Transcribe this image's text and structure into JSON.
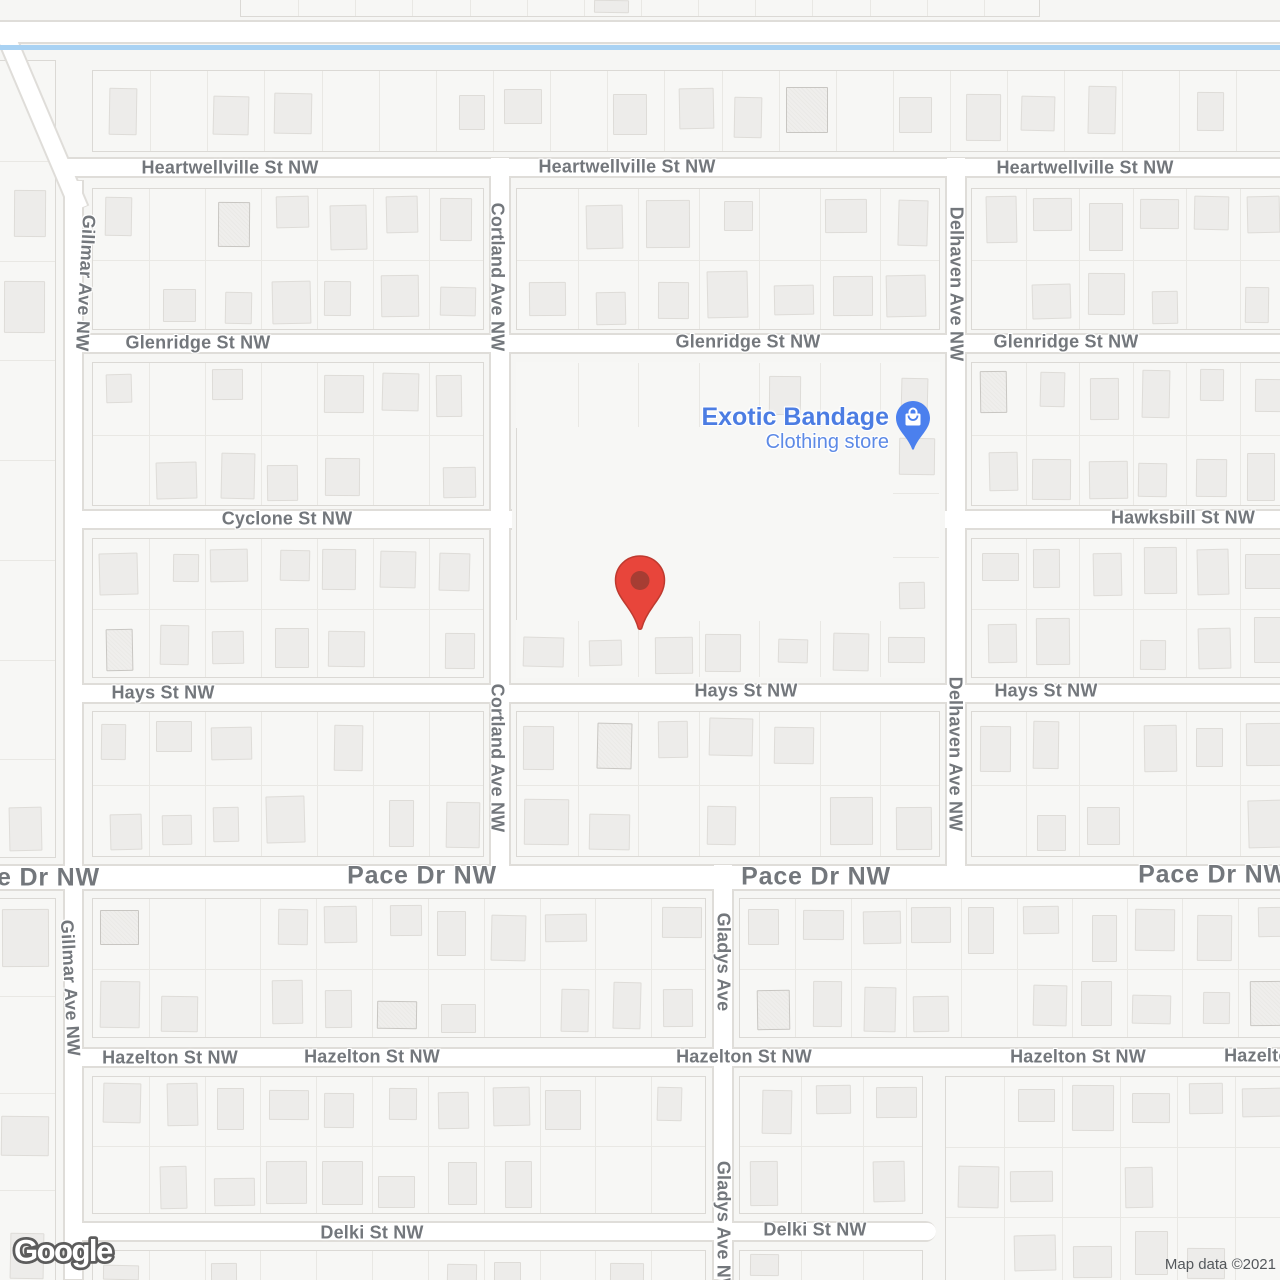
{
  "attribution": {
    "text": "Map data ©2021"
  },
  "logo": {
    "text": "Google"
  },
  "poi": {
    "title": "Exotic Bandage",
    "subtitle": "Clothing store",
    "title_color": "#4c7de3",
    "subtitle_color": "#5d8ae6",
    "icon": {
      "name": "shopping-bag-pin-icon",
      "x": 913,
      "y": 418,
      "color": "#4B80EE"
    }
  },
  "marker": {
    "name": "red-map-pin",
    "x": 640,
    "y": 580,
    "color": "#E8453B",
    "stroke": "#BE3A2F",
    "dot": "#A63D33"
  },
  "theme": {
    "background": "#f6f6f4",
    "block_fill": "#f7f7f5",
    "block_border": "#dbd9d5",
    "lot_line": "#e9e8e4",
    "building_fill": "#edecea",
    "building_border": "#dedcd8",
    "road_fill": "#ffffff",
    "road_casing": "#dfddd9",
    "label_color": "#73777c",
    "water_color": "#a9d2f3"
  },
  "map": {
    "seed": 11,
    "water": {
      "x": 0,
      "y": 45,
      "w": 1280,
      "h": 5
    },
    "roads": [
      {
        "o": "h",
        "x": 0,
        "y": 20,
        "w": 1280,
        "h": 24
      },
      {
        "o": "h",
        "x": 60,
        "y": 157,
        "w": 1220,
        "h": 21
      },
      {
        "o": "h",
        "x": 80,
        "y": 333,
        "w": 1200,
        "h": 21
      },
      {
        "o": "h",
        "x": 80,
        "y": 509,
        "w": 432,
        "h": 21
      },
      {
        "o": "h",
        "x": 945,
        "y": 509,
        "w": 335,
        "h": 21
      },
      {
        "o": "h",
        "x": 78,
        "y": 683,
        "w": 1202,
        "h": 21
      },
      {
        "o": "h",
        "x": 0,
        "y": 864,
        "w": 1280,
        "h": 27,
        "major": true
      },
      {
        "o": "h",
        "x": 78,
        "y": 1047,
        "w": 1202,
        "h": 21
      },
      {
        "o": "h",
        "x": 78,
        "y": 1221,
        "w": 858,
        "h": 21,
        "cap": "right"
      },
      {
        "o": "v",
        "x": 32,
        "y": 27,
        "w": 21,
        "h": 190,
        "rot": -23
      },
      {
        "o": "v",
        "x": 63,
        "y": 180,
        "w": 21,
        "h": 1100
      },
      {
        "o": "v",
        "x": 489,
        "y": 157,
        "w": 22,
        "h": 733
      },
      {
        "o": "v",
        "x": 945,
        "y": 157,
        "w": 22,
        "h": 733
      },
      {
        "o": "v",
        "x": 712,
        "y": 864,
        "w": 22,
        "h": 416
      }
    ],
    "blocks": [
      {
        "x": 240,
        "y": -6,
        "w": 800,
        "h": 23,
        "rows": 1,
        "d": 0.15
      },
      {
        "x": 92,
        "y": 70,
        "w": 1200,
        "h": 82,
        "rows": 1,
        "d": 0.7
      },
      {
        "x": 92,
        "y": 188,
        "w": 392,
        "h": 142,
        "rows": 2,
        "d": 0.75
      },
      {
        "x": 516,
        "y": 188,
        "w": 424,
        "h": 142,
        "rows": 2,
        "d": 0.75
      },
      {
        "x": 971,
        "y": 188,
        "w": 321,
        "h": 142,
        "rows": 2,
        "d": 0.8
      },
      {
        "x": 92,
        "y": 362,
        "w": 392,
        "h": 144,
        "rows": 2,
        "d": 0.7
      },
      {
        "x": 971,
        "y": 362,
        "w": 321,
        "h": 144,
        "rows": 2,
        "d": 0.8
      },
      {
        "x": 92,
        "y": 538,
        "w": 392,
        "h": 140,
        "rows": 2,
        "d": 0.65
      },
      {
        "x": 971,
        "y": 538,
        "w": 321,
        "h": 140,
        "rows": 2,
        "d": 0.8
      },
      {
        "x": 516,
        "y": 362,
        "w": 424,
        "h": 316,
        "rows": 0,
        "d": 0
      },
      {
        "x": 516,
        "y": 362,
        "w": 424,
        "h": 66,
        "rows": 1,
        "d": 0.7,
        "noborder": true
      },
      {
        "x": 892,
        "y": 428,
        "w": 48,
        "h": 192,
        "rows": 3,
        "d": 0.85,
        "noborder": true
      },
      {
        "x": 516,
        "y": 620,
        "w": 424,
        "h": 58,
        "rows": 1,
        "d": 0.8,
        "noborder": true
      },
      {
        "x": 92,
        "y": 711,
        "w": 392,
        "h": 146,
        "rows": 2,
        "d": 0.7
      },
      {
        "x": 516,
        "y": 711,
        "w": 424,
        "h": 146,
        "rows": 2,
        "d": 0.75
      },
      {
        "x": 971,
        "y": 711,
        "w": 321,
        "h": 146,
        "rows": 2,
        "d": 0.8
      },
      {
        "x": 92,
        "y": 898,
        "w": 614,
        "h": 140,
        "rows": 2,
        "d": 0.75
      },
      {
        "x": 739,
        "y": 898,
        "w": 553,
        "h": 140,
        "rows": 2,
        "d": 0.8
      },
      {
        "x": 92,
        "y": 1076,
        "w": 614,
        "h": 138,
        "rows": 2,
        "d": 0.75
      },
      {
        "x": 739,
        "y": 1076,
        "w": 184,
        "h": 138,
        "rows": 2,
        "d": 0.8
      },
      {
        "x": 945,
        "y": 1076,
        "w": 347,
        "h": 210,
        "rows": 3,
        "d": 0.7
      },
      {
        "x": 92,
        "y": 1250,
        "w": 614,
        "h": 36,
        "rows": 1,
        "d": 0.5
      },
      {
        "x": 739,
        "y": 1250,
        "w": 184,
        "h": 36,
        "rows": 1,
        "d": 0.5
      },
      {
        "x": -8,
        "y": 60,
        "w": 64,
        "h": 798,
        "rows": 8,
        "d": 0.5
      },
      {
        "x": -8,
        "y": 898,
        "w": 64,
        "h": 388,
        "rows": 4,
        "d": 0.55
      }
    ],
    "labels": [
      {
        "t": "Heartwellville St NW",
        "x": 230,
        "y": 168,
        "r": 0,
        "c": "minor"
      },
      {
        "t": "Heartwellville St NW",
        "x": 627,
        "y": 167,
        "r": 0,
        "c": "minor"
      },
      {
        "t": "Heartwellville St NW",
        "x": 1085,
        "y": 168,
        "r": 0,
        "c": "minor"
      },
      {
        "t": "Glenridge St NW",
        "x": 198,
        "y": 343,
        "r": 0,
        "c": "minor"
      },
      {
        "t": "Glenridge St NW",
        "x": 748,
        "y": 342,
        "r": 0,
        "c": "minor"
      },
      {
        "t": "Glenridge St NW",
        "x": 1066,
        "y": 342,
        "r": 0,
        "c": "minor"
      },
      {
        "t": "Cyclone St NW",
        "x": 287,
        "y": 519,
        "r": 0,
        "c": "minor"
      },
      {
        "t": "Hawksbill St NW",
        "x": 1183,
        "y": 518,
        "r": 0,
        "c": "minor"
      },
      {
        "t": "Hays St NW",
        "x": 163,
        "y": 693,
        "r": 0,
        "c": "minor"
      },
      {
        "t": "Hays St NW",
        "x": 746,
        "y": 691,
        "r": 0,
        "c": "minor"
      },
      {
        "t": "Hays St NW",
        "x": 1046,
        "y": 691,
        "r": 0,
        "c": "minor"
      },
      {
        "t": "Pace Dr NW",
        "x": 25,
        "y": 878,
        "r": 0,
        "c": "major"
      },
      {
        "t": "Pace Dr NW",
        "x": 422,
        "y": 876,
        "r": 0,
        "c": "major"
      },
      {
        "t": "Pace Dr NW",
        "x": 816,
        "y": 877,
        "r": 0,
        "c": "major"
      },
      {
        "t": "Pace Dr NW",
        "x": 1213,
        "y": 875,
        "r": 0,
        "c": "major"
      },
      {
        "t": "Hazelton St NW",
        "x": 170,
        "y": 1058,
        "r": 0,
        "c": "minor"
      },
      {
        "t": "Hazelton St NW",
        "x": 372,
        "y": 1057,
        "r": 0,
        "c": "minor"
      },
      {
        "t": "Hazelton St NW",
        "x": 744,
        "y": 1057,
        "r": 0,
        "c": "minor"
      },
      {
        "t": "Hazelton St NW",
        "x": 1078,
        "y": 1057,
        "r": 0,
        "c": "minor"
      },
      {
        "t": "Hazelton St NW",
        "x": 1292,
        "y": 1056,
        "r": 0,
        "c": "minor"
      },
      {
        "t": "Delki St NW",
        "x": 372,
        "y": 1233,
        "r": 0,
        "c": "minor"
      },
      {
        "t": "Delki St NW",
        "x": 815,
        "y": 1230,
        "r": 0,
        "c": "minor"
      },
      {
        "t": "Gillmar Ave NW",
        "x": 85,
        "y": 283,
        "r": 93,
        "c": "minor"
      },
      {
        "t": "Gillmar Ave NW",
        "x": 70,
        "y": 988,
        "r": 87,
        "c": "minor"
      },
      {
        "t": "Cortland Ave NW",
        "x": 497,
        "y": 277,
        "r": 90,
        "c": "minor"
      },
      {
        "t": "Cortland Ave NW",
        "x": 497,
        "y": 758,
        "r": 90,
        "c": "minor"
      },
      {
        "t": "Delhaven Ave NW",
        "x": 956,
        "y": 284,
        "r": 90,
        "c": "minor"
      },
      {
        "t": "Delhaven Ave NW",
        "x": 955,
        "y": 754,
        "r": 90,
        "c": "minor"
      },
      {
        "t": "Gladys Ave",
        "x": 723,
        "y": 962,
        "r": 90,
        "c": "minor"
      },
      {
        "t": "Gladys Ave NW",
        "x": 723,
        "y": 1228,
        "r": 90,
        "c": "minor"
      }
    ]
  }
}
